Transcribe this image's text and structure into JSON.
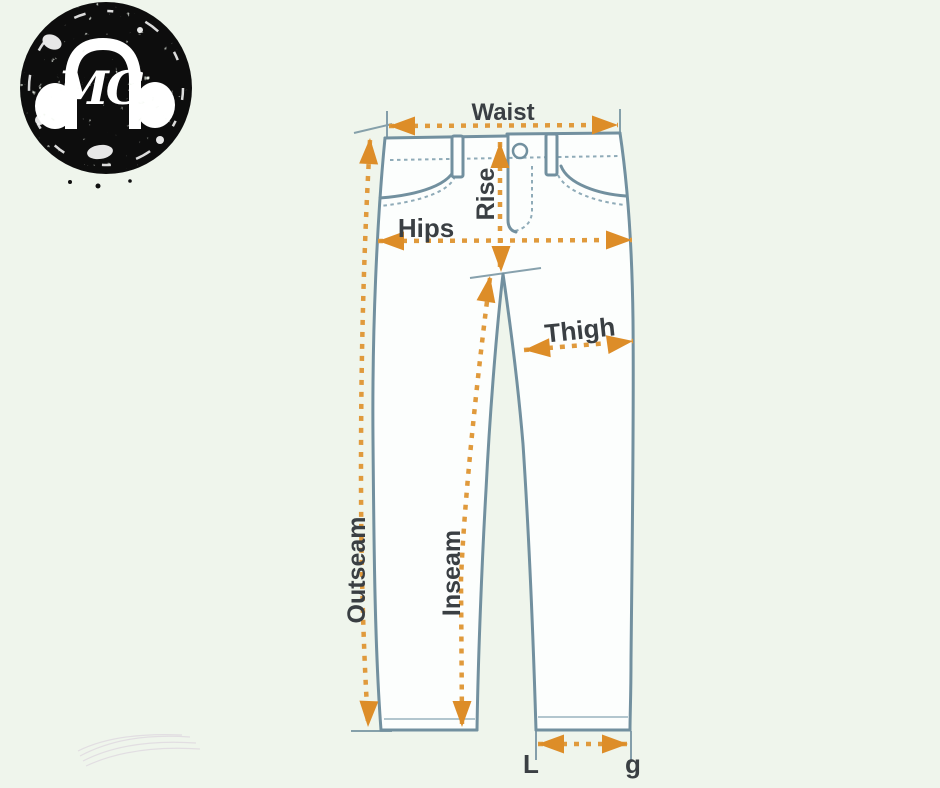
{
  "logo": {
    "monogram": "MG",
    "icon": "headphones-icon"
  },
  "diagram": {
    "labels": {
      "waist": "Waist",
      "rise": "Rise",
      "hips": "Hips",
      "thigh": "Thigh",
      "outseam": "Outseam",
      "inseam": "Inseam",
      "leg_opening_partial_start": "L",
      "leg_opening_partial_end": "g"
    }
  },
  "colors": {
    "background": "#eff5ec",
    "denim_fill": "#fcfefd",
    "outline": "#72909f",
    "stitch": "#8fabb8",
    "arrow": "#e09a3c",
    "arrowhead": "#dd8d28",
    "label_text": "#3a3f43",
    "watermark": "#ded7df",
    "logo_bg": "#101010",
    "logo_fg": "#ffffff"
  }
}
